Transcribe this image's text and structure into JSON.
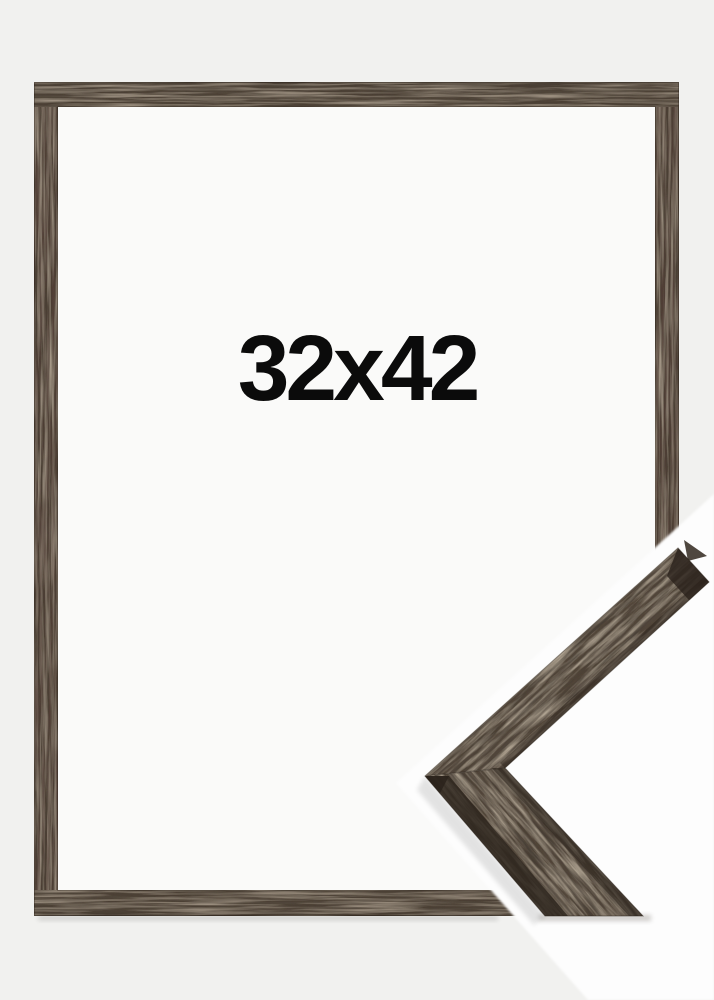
{
  "frame": {
    "size_label": "32x42"
  },
  "colors": {
    "background": "#f1f1ef",
    "opening": "#fafaf9",
    "photo_white": "#fdfdfd",
    "wood_base": "#4b4034",
    "wood_detail": "#52463a",
    "wood_side": "#2a221b",
    "edge_line": "#241c14",
    "label": "#0b0b0b"
  }
}
